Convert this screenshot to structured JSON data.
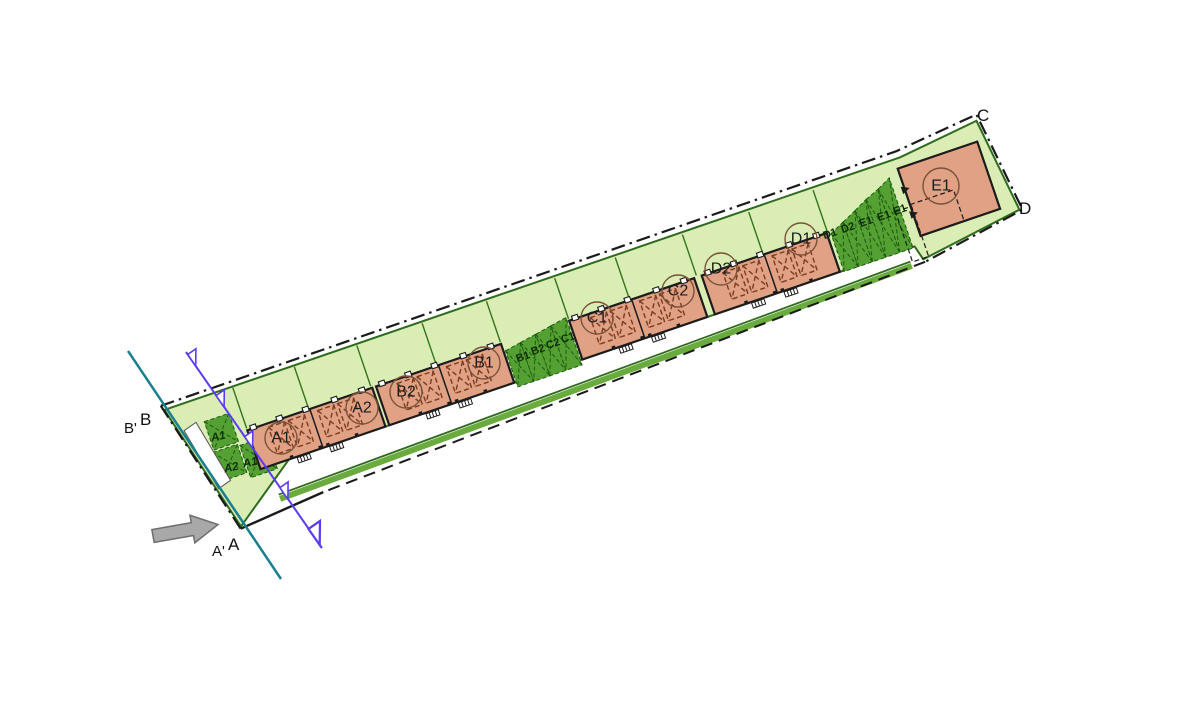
{
  "colors": {
    "site_green": "#d9edb4",
    "plot_green": "#54a033",
    "plot_outline": "#1d5c10",
    "building_fill": "#e0a184",
    "building_outline": "#1c1c1c",
    "edge_green": "#2e6b1d",
    "hedge_green": "#6aab3e",
    "boundary_black": "#1a1a1a",
    "section_blue": "#5b3cf0",
    "utility_teal": "#1a808f",
    "arrow_gray": "#a8a8a8",
    "roof_hatch_brown": "#7e3c1e"
  },
  "buildings": {
    "labels": [
      "A1",
      "A2",
      "B2",
      "B1",
      "C1",
      "C2",
      "D2",
      "D1",
      "E1"
    ]
  },
  "plots": {
    "a": [
      "A1",
      "A2",
      "A1"
    ],
    "bc": [
      "B1",
      "B2",
      "C2",
      "C1"
    ],
    "de": [
      "D1",
      "D2",
      "E1",
      "E1",
      "E1"
    ]
  },
  "sections": {
    "b_prime": "B'",
    "b": "B",
    "a_prime": "A'",
    "a": "A",
    "c": "C",
    "d": "D"
  }
}
